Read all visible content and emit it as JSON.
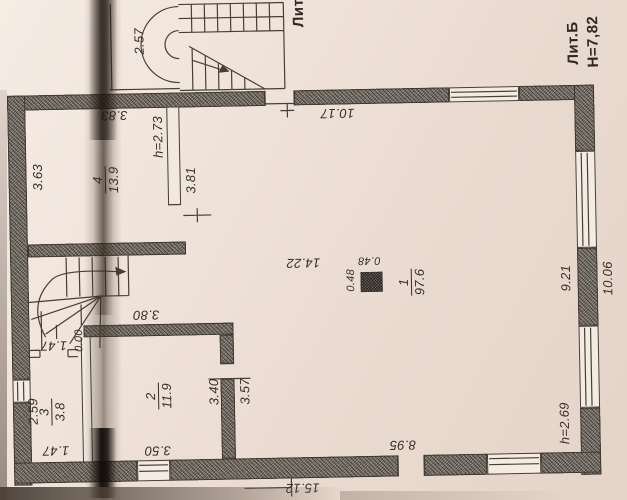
{
  "building": {
    "liter": "Лит.Б",
    "height_mark": "Н=7,82"
  },
  "porch": {
    "liter": "Лит.",
    "width": "2.57"
  },
  "rooms": {
    "hall": {
      "number": "1",
      "area": "97.6"
    },
    "room2": {
      "number": "2",
      "area": "11.9"
    },
    "room3": {
      "number": "3",
      "area": "3.8"
    },
    "room4": {
      "number": "4",
      "area": "13.9"
    }
  },
  "dims": {
    "top_inner": "10.17",
    "right_inner": "9.21",
    "right_outer": "10.06",
    "bottom_inner": "8.95",
    "bottom_outer": "15.12",
    "hall_mid": "14.22",
    "column_w": "0.48",
    "column_h": "0.48",
    "height_hall": "h=2.69",
    "height_room4": "h=2.73",
    "room4_left": "3.63",
    "room4_top": "3.83",
    "room4_wall": "3.81",
    "room2_top": "3.80",
    "room2_bottom": "3.50",
    "room2_right": "3.40",
    "room2_door": "3.57",
    "room3_left": "2.59",
    "room3_top": "1.47",
    "room3_bottom": "1.47",
    "stair_level": "0.00"
  }
}
